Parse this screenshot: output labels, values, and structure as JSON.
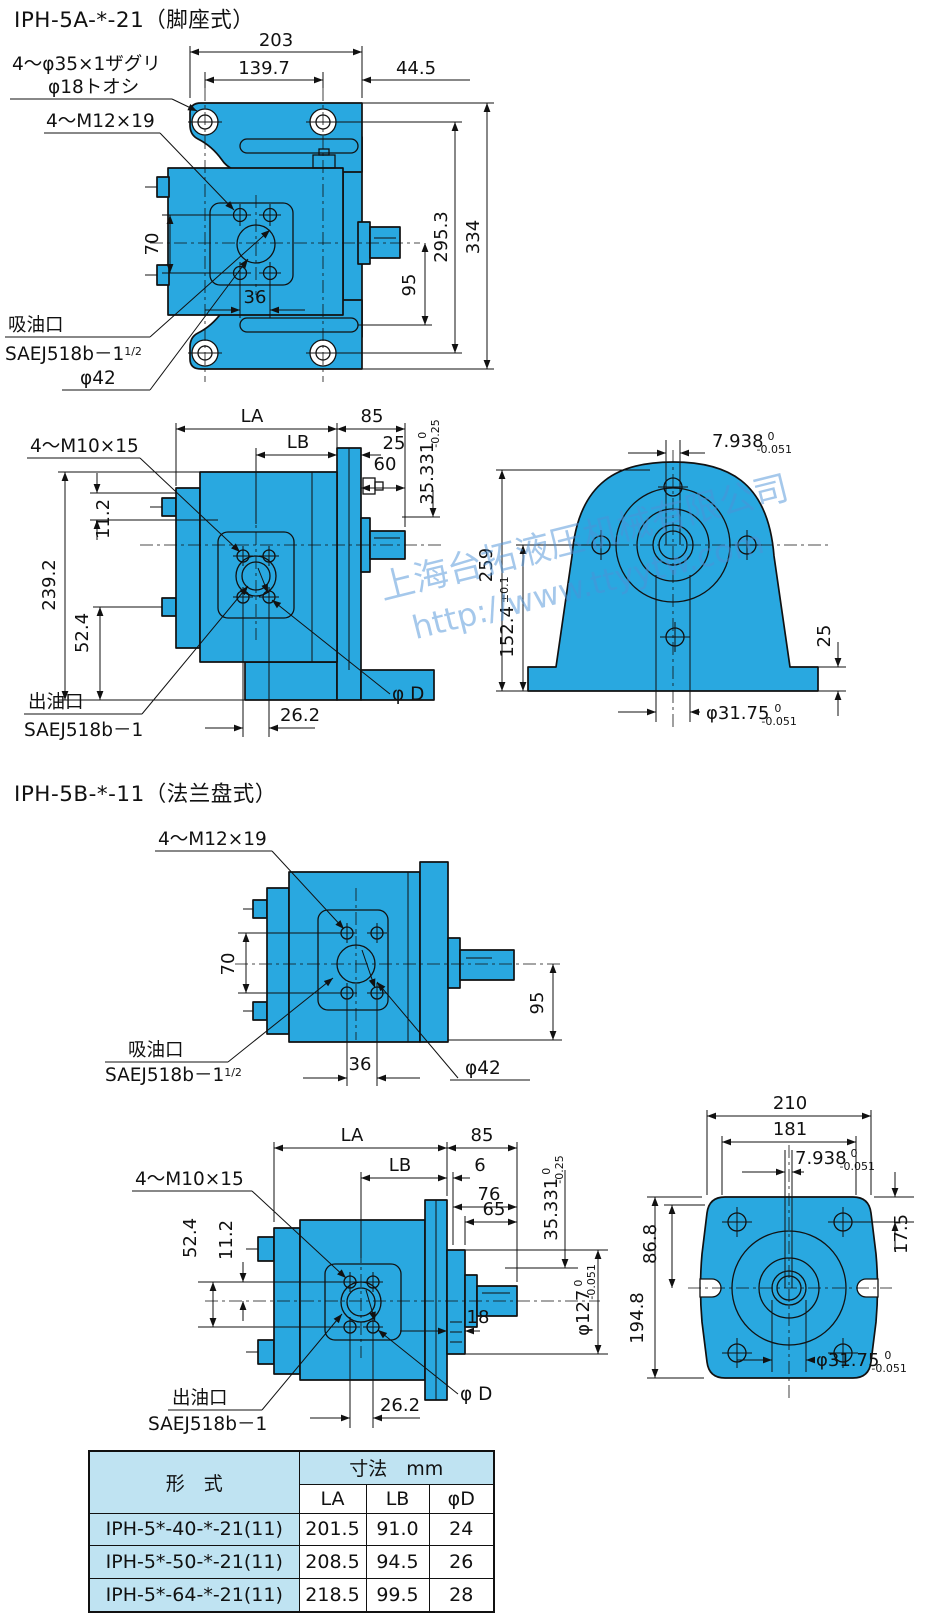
{
  "titles": {
    "section_a": "IPH-5A-*-21（脚座式）",
    "section_b": "IPH-5B-*-11（法兰盘式）"
  },
  "watermark": {
    "line1": "上海台拓液压机械有限公司",
    "line2": "http://www.ttyytw.com"
  },
  "colors": {
    "pump_fill": "#29a8e0",
    "table_header_fill": "#bfe3f2",
    "watermark_color": "#4d92d8",
    "line_color": "#111111"
  },
  "a_top": {
    "d203": "203",
    "d139_7": "139.7",
    "d44_5": "44.5",
    "d70": "70",
    "d36": "36",
    "d95": "95",
    "d295_3": "295.3",
    "d334": "334",
    "counterbore_line1": "4～φ35×1ザグリ",
    "counterbore_line2": "φ18トオシ",
    "bolt_label": "4～M12×19",
    "suction_title": "吸油口",
    "suction_port": "SAEJ518b－1",
    "suction_frac": "1/2",
    "phi42": "φ42"
  },
  "a_side": {
    "dLA": "LA",
    "d85": "85",
    "dLB": "LB",
    "d25": "25",
    "d60": "60",
    "d35_331": "35.331",
    "d35_tol_hi": "0",
    "d35_tol_lo": "-0.25",
    "bolt_label": "4～M10×15",
    "d11_2": "11.2",
    "d239_2": "239.2",
    "d52_4": "52.4",
    "d26_2": "26.2",
    "phiD": "φ D",
    "outlet_title": "出油口",
    "outlet_port": "SAEJ518b－1"
  },
  "a_end": {
    "d7_938": "7.938",
    "d7_tol_hi": "0",
    "d7_tol_lo": "-0.051",
    "d259": "259",
    "d152_4": "152.4",
    "d152_tol": "±0.1",
    "d25": "25",
    "phi31_75": "φ31.75",
    "phi31_tol_hi": "0",
    "phi31_tol_lo": "-0.051"
  },
  "b_top": {
    "bolt_label": "4～M12×19",
    "d70": "70",
    "d95": "95",
    "d36": "36",
    "suction_title": "吸油口",
    "suction_port": "SAEJ518b－1",
    "suction_frac": "1/2",
    "phi42": "φ42"
  },
  "b_side": {
    "dLA": "LA",
    "d85": "85",
    "dLB": "LB",
    "d6": "6",
    "d76": "76",
    "d65": "65",
    "d35_331": "35.331",
    "d35_tol_hi": "0",
    "d35_tol_lo": "-0.25",
    "bolt_label": "4～M10×15",
    "d52_4": "52.4",
    "d11_2": "11.2",
    "phi127": "φ127",
    "phi127_tol_hi": "0",
    "phi127_tol_lo": "-0.051",
    "d18": "18",
    "d26_2": "26.2",
    "phiD": "φ D",
    "outlet_title": "出油口",
    "outlet_port": "SAEJ518b－1"
  },
  "b_end": {
    "d210": "210",
    "d181": "181",
    "d7_938": "7.938",
    "d7_tol_hi": "0",
    "d7_tol_lo": "-0.051",
    "d17_5": "17.5",
    "d86_8": "86.8",
    "d194_8": "194.8",
    "phi31_75": "φ31.75",
    "phi31_tol_hi": "0",
    "phi31_tol_lo": "-0.051"
  },
  "table": {
    "header_model": "形　式",
    "header_dims": "寸法　mm",
    "col_la": "LA",
    "col_lb": "LB",
    "col_phid": "φD",
    "rows": [
      {
        "model": "IPH-5*-40-*-21(11)",
        "la": "201.5",
        "lb": "91.0",
        "d": "24"
      },
      {
        "model": "IPH-5*-50-*-21(11)",
        "la": "208.5",
        "lb": "94.5",
        "d": "26"
      },
      {
        "model": "IPH-5*-64-*-21(11)",
        "la": "218.5",
        "lb": "99.5",
        "d": "28"
      }
    ]
  }
}
